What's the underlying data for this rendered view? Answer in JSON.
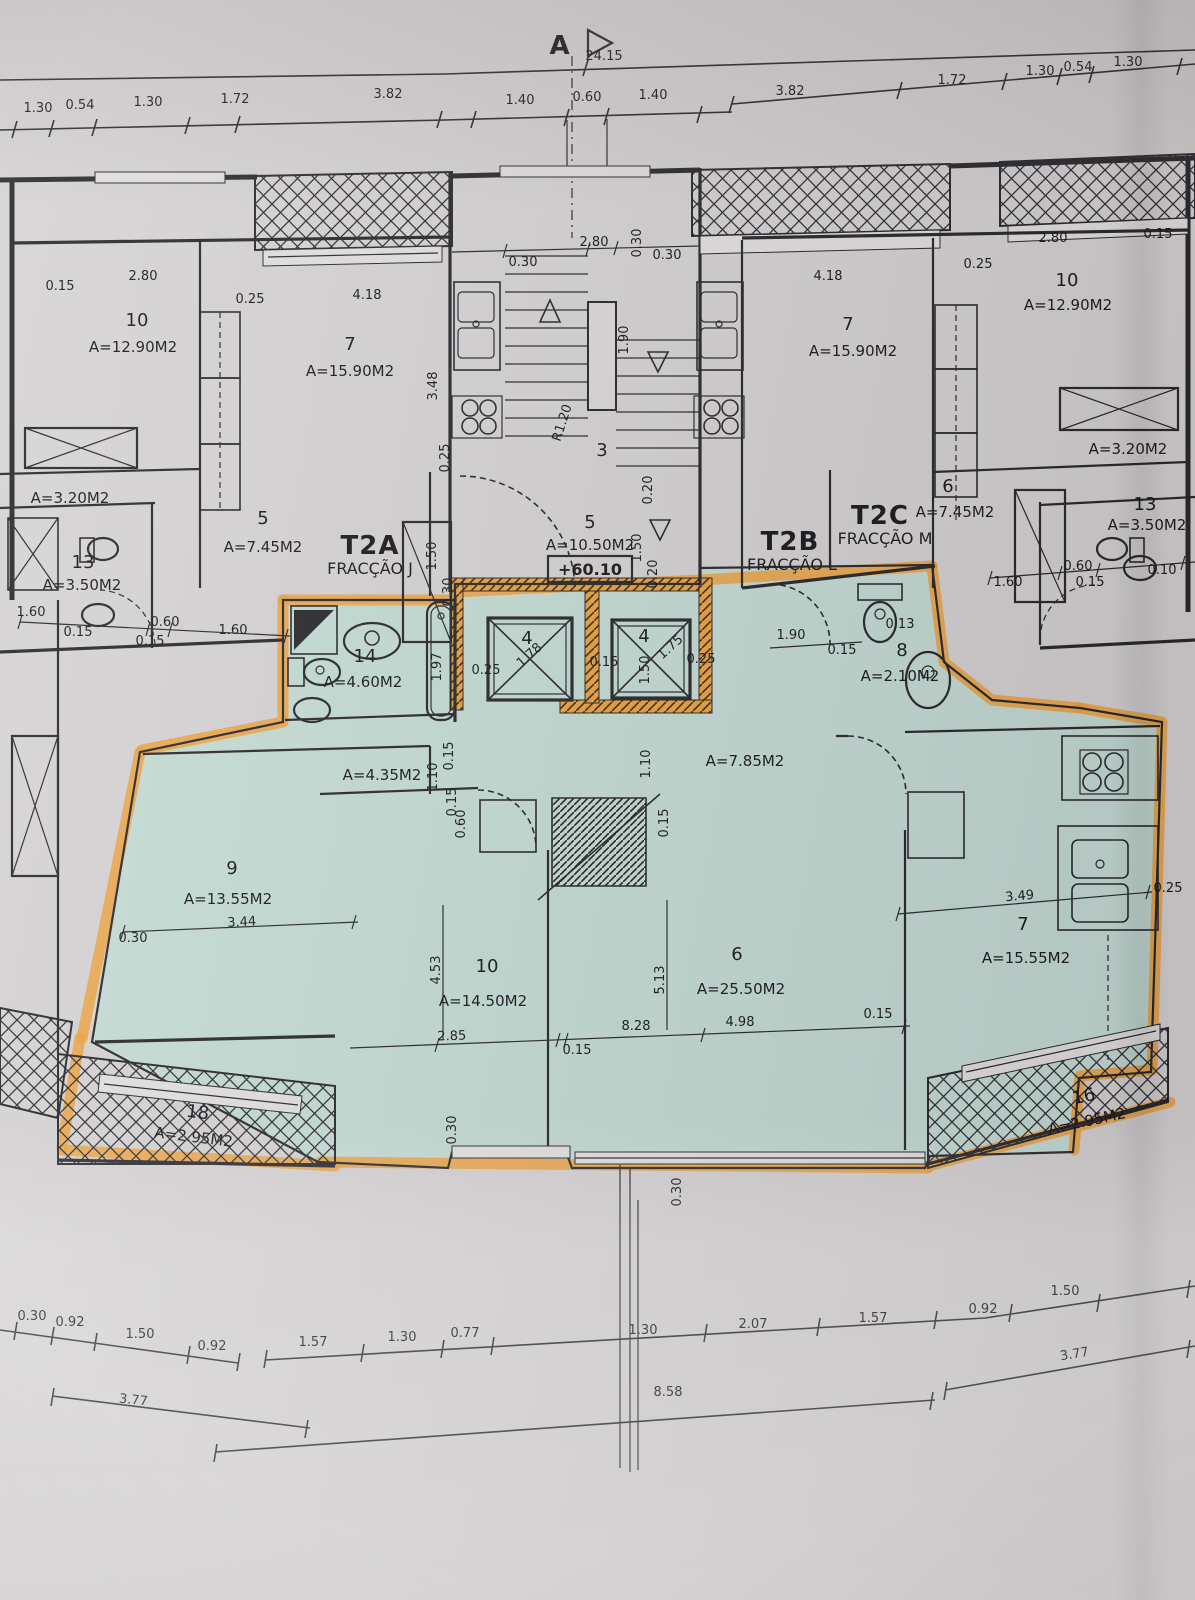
{
  "section_marker": {
    "label": "A",
    "total": "24.15"
  },
  "elevation": "+60.10",
  "units": {
    "t2a": {
      "code": "T2A",
      "fraction": "FRACÇÃO J"
    },
    "t2b": {
      "code": "T2B",
      "fraction": "FRACÇÃO L"
    },
    "t2c": {
      "code": "T2C",
      "fraction": "FRACÇÃO M"
    }
  },
  "rooms": {
    "ul10": {
      "num": "10",
      "area": "A=12.90M2"
    },
    "ul7": {
      "num": "7",
      "area": "A=15.90M2"
    },
    "ulstore": {
      "area": "A=3.20M2"
    },
    "ul5": {
      "num": "5",
      "area": "A=7.45M2"
    },
    "ul13": {
      "num": "13",
      "area": "A=3.50M2"
    },
    "stair": {
      "num": "3"
    },
    "hall": {
      "num": "5",
      "area": "A=10.50M2"
    },
    "ur7": {
      "num": "7",
      "area": "A=15.90M2"
    },
    "ur10": {
      "num": "10",
      "area": "A=12.90M2"
    },
    "ur6": {
      "num": "6",
      "area": "A=7.45M2"
    },
    "ur13": {
      "num": "13",
      "area": "A=3.50M2"
    },
    "urstore": {
      "area": "A=3.20M2"
    },
    "bath14": {
      "num": "14",
      "area": "A=4.60M2"
    },
    "elevL": {
      "num": "4"
    },
    "elevR": {
      "num": "4"
    },
    "wc8": {
      "num": "8",
      "area": "A=2.10M2"
    },
    "hall435": {
      "area": "A=4.35M2"
    },
    "corr785": {
      "area": "A=7.85M2"
    },
    "room9": {
      "num": "9",
      "area": "A=13.55M2"
    },
    "room10": {
      "num": "10",
      "area": "A=14.50M2"
    },
    "room6": {
      "num": "6",
      "area": "A=25.50M2"
    },
    "room7": {
      "num": "7",
      "area": "A=15.55M2"
    },
    "balc18": {
      "num": "18",
      "area": "A=2.95M2"
    },
    "balc16": {
      "num": "16",
      "area": "A=2.95M2"
    }
  },
  "dims": {
    "tl1": "1.30",
    "tl2": "0.54",
    "tl3": "1.30",
    "tl4": "1.72",
    "tl5": "3.82",
    "tc1": "1.40",
    "tc2": "0.60",
    "tc3": "1.40",
    "tr1": "3.82",
    "tr2": "1.72",
    "tr3": "1.30",
    "tr4": "0.54",
    "tr5": "1.30",
    "u1": "2.80",
    "u2": "0.15",
    "u3": "0.25",
    "u4": "4.18",
    "u5": "3.48",
    "u6": "0.25",
    "s1": "0.30",
    "s2": "2.80",
    "s3": "0.30",
    "s4": "0.30",
    "s5": "R1.20",
    "s6": "1.90",
    "r1": "4.18",
    "r2": "0.25",
    "r3": "2.80",
    "r4": "0.15",
    "ml1": "1.60",
    "ml2": "0.15",
    "ml3": "0.60",
    "ml4": "0.15",
    "ml5": "1.60",
    "mr1": "1.60",
    "mr2": "0.60",
    "mr3": "0.15",
    "mr4": "0.10",
    "c1": "1.50",
    "c2": "0.20",
    "c3": "1.50",
    "c4": "0.20",
    "c5": "0.30",
    "b1": "1.97",
    "e1": "0.25",
    "e2": "1.78",
    "e3": "0.15",
    "e4": "1.50",
    "e5": "1.75",
    "e6": "0.25",
    "w1": "1.90",
    "w2": "0.15",
    "w3": "0.13",
    "h1": "1.10",
    "h2": "0.15",
    "h3": "0.15",
    "h4": "1.10",
    "h5": "0.15",
    "h6": "0.60",
    "n1": "3.44",
    "n2": "0.30",
    "n3": "4.53",
    "n4": "2.85",
    "n5": "0.15",
    "n6": "5.13",
    "n7": "8.28",
    "n8": "4.98",
    "n9": "3.49",
    "n10": "0.25",
    "n11": "0.15",
    "n12": "0.30",
    "n13": "0.30",
    "q1": "0.30",
    "q2": "0.92",
    "q3": "1.50",
    "q4": "0.92",
    "q5": "1.57",
    "q6": "1.30",
    "q7": "0.77",
    "q8": "1.30",
    "q9": "2.07",
    "q10": "1.57",
    "q11": "0.92",
    "q12": "1.50",
    "p1": "3.77",
    "p2": "8.58",
    "p3": "3.77"
  }
}
